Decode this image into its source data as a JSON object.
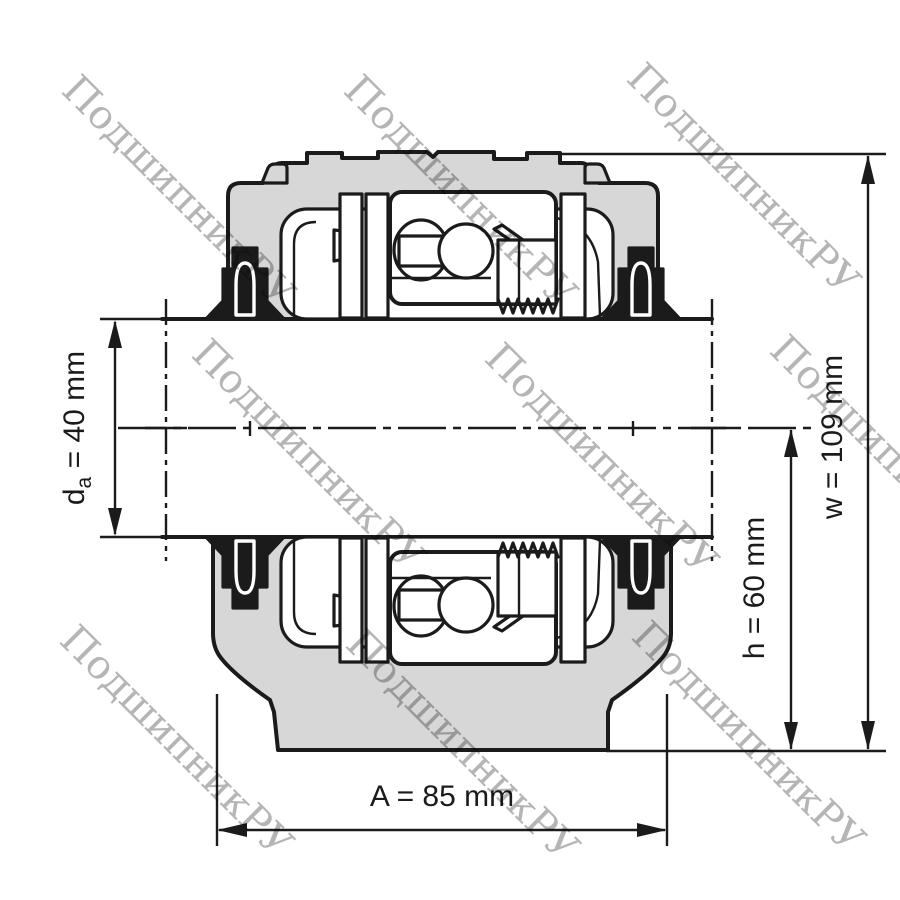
{
  "colors": {
    "line": "#1b1b1b",
    "housing-fill": "#d7d7d7",
    "background": "#ffffff",
    "watermark": "#b1b1b1"
  },
  "watermark": {
    "text": "ПодшипникРУ"
  },
  "dimensions": {
    "da": {
      "symbol": "d",
      "subscript": "a",
      "rest": " = 40 mm",
      "value_mm": 40
    },
    "w": {
      "label": "w = 109 mm",
      "value_mm": 109
    },
    "h": {
      "label": "h = 60 mm",
      "value_mm": 60
    },
    "A": {
      "label": "A = 85 mm",
      "value_mm": 85
    }
  }
}
